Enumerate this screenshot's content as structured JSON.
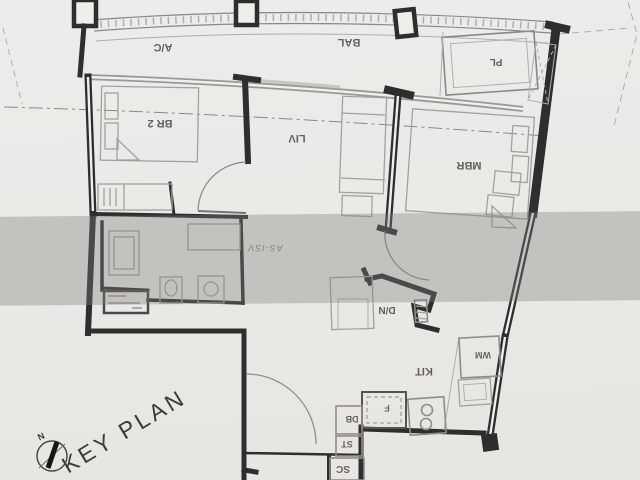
{
  "scan": {
    "rooms": {
      "ac": "A/C",
      "bal": "BAL",
      "pl": "PL",
      "br2": "BR 2",
      "liv": "LIV",
      "mbr": "MBR",
      "dn": "D/N",
      "kit": "KIT"
    },
    "fixtures": {
      "wm": "WM",
      "fridge": "F",
      "db": "DB",
      "st": "ST",
      "sc": "SC"
    },
    "annotations": {
      "key_plan": "KEY PLAN",
      "north": "N",
      "watermark": "AS-ISV"
    },
    "colors": {
      "paper": "#ebe9e6",
      "wall": "#2f2e2c",
      "light_line": "#a3a19d",
      "watermark_band": "#807f7b"
    }
  }
}
